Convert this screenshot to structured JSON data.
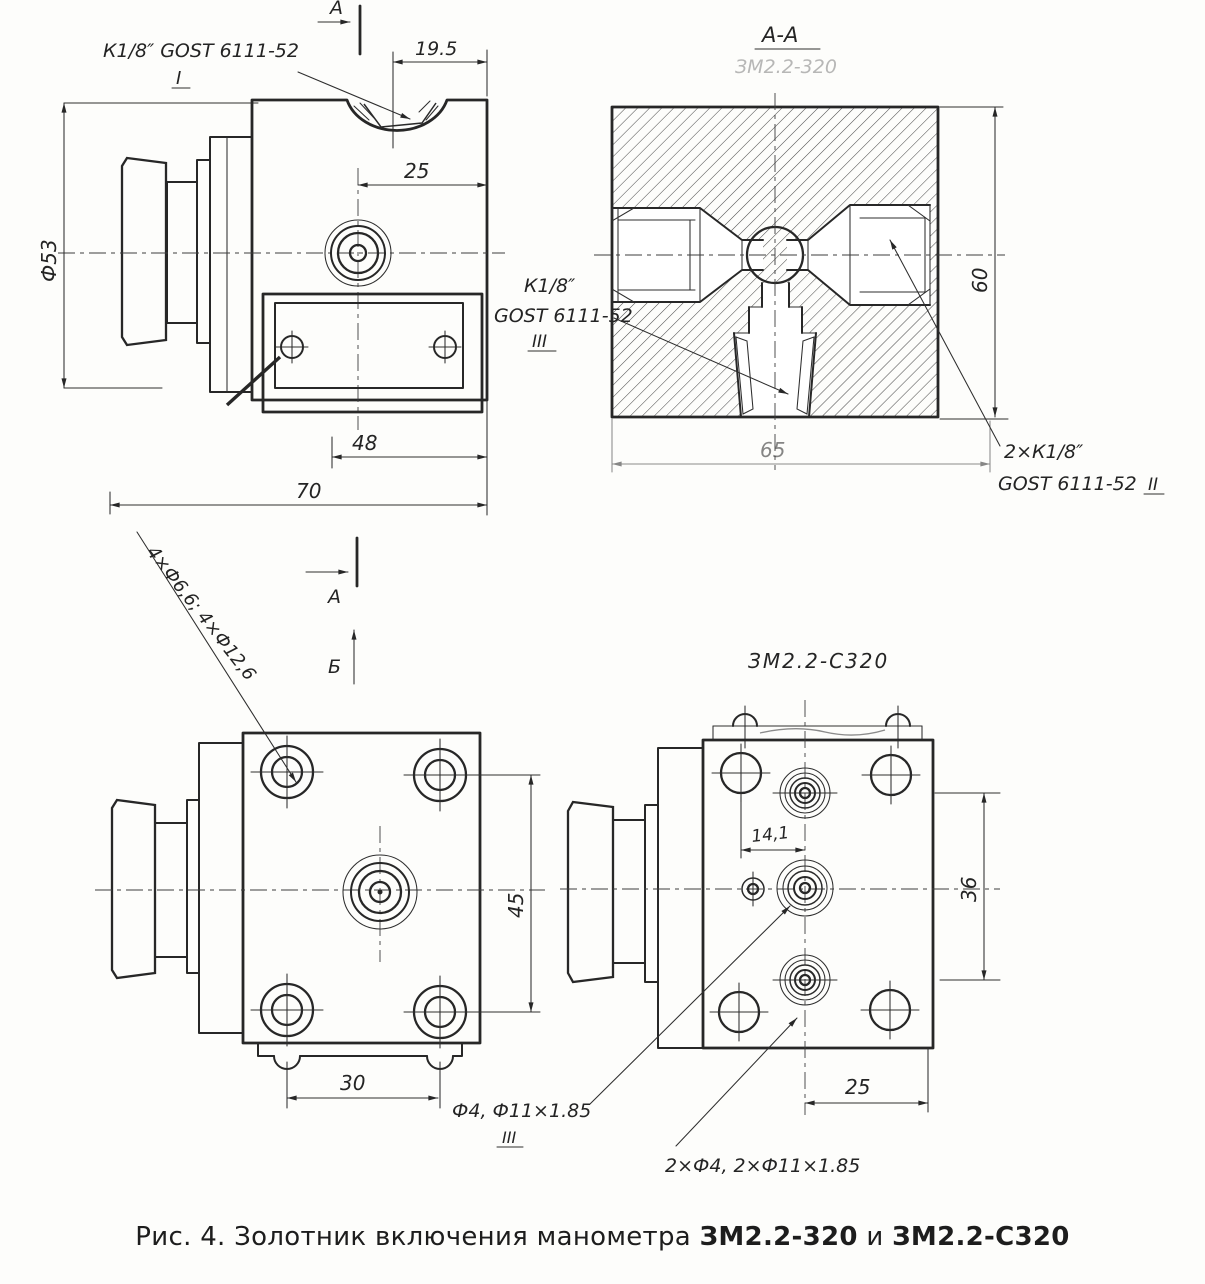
{
  "figure": {
    "caption_prefix": "Рис. 4. Золотник включения манометра",
    "caption_model_1": "ЗМ2.2-320",
    "caption_conjunction": "и",
    "caption_model_2": "ЗМ2.2-С320"
  },
  "front_view": {
    "section_arrow_top": "А",
    "port1_label": "К1/8″ GOST 6111-52",
    "port1_numeral": "I",
    "dim_width_notch": "19.5",
    "dim_port_offset": "25",
    "dim_knob_diameter": "Ф53",
    "dim_plate_holes": "48",
    "dim_body_width": "70"
  },
  "section_view": {
    "title": "А-А",
    "subtitle": "ЗМ2.2-320",
    "dim_height": "60",
    "dim_width": "65",
    "port3_label_line1": "К1/8″",
    "port3_label_line2": "GOST 6111-52",
    "port3_numeral": "III",
    "port2_label_line1": "2×К1/8″",
    "port2_label_line2": "GOST 6111-52",
    "port2_numeral": "II"
  },
  "bottom_view": {
    "holes_label": "4×Ф6,6; 4×Ф12,6",
    "section_arrow_a": "А",
    "view_arrow_b": "Б",
    "dim_hole_spacing": "30",
    "dim_hole_spacing_v": "45",
    "port_label": "Ф4, Ф11×1.85",
    "port_numeral": "III"
  },
  "s320_view": {
    "title": "ЗМ2.2-С320",
    "dim_port_offset": "14,1",
    "dim_port_spacing": "36",
    "dim_edge_offset": "25",
    "ports_label": "2×Ф4, 2×Ф11×1.85"
  }
}
